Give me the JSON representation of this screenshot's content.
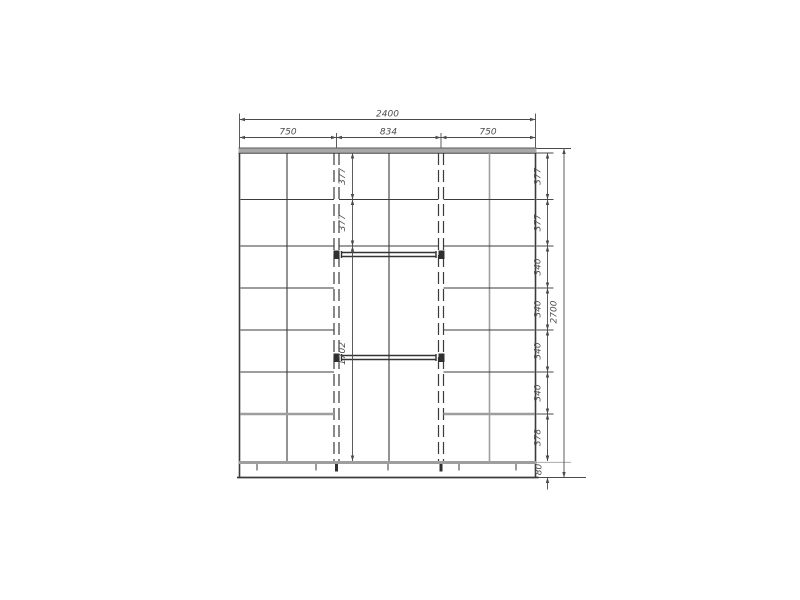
{
  "page": {
    "background": "#ffffff"
  },
  "drawing": {
    "type": "wardrobe-front-elevation-technical-drawing",
    "dims": {
      "overall_width": "2400",
      "sections": [
        "750",
        "834",
        "750"
      ],
      "overall_height": "2700",
      "base_height": "80",
      "right_rows": [
        "377",
        "377",
        "340",
        "340",
        "340",
        "340",
        "378"
      ],
      "middle_rows": [
        "377",
        "377",
        "1702"
      ]
    },
    "colors": {
      "line_dark": "#3b3b3b",
      "line_gray": "#9e9e9e",
      "panel_gray": "#a8a8a8",
      "dim_line": "#4a4a4a",
      "dim_text": "#4d4d4d",
      "background": "#ffffff"
    }
  }
}
